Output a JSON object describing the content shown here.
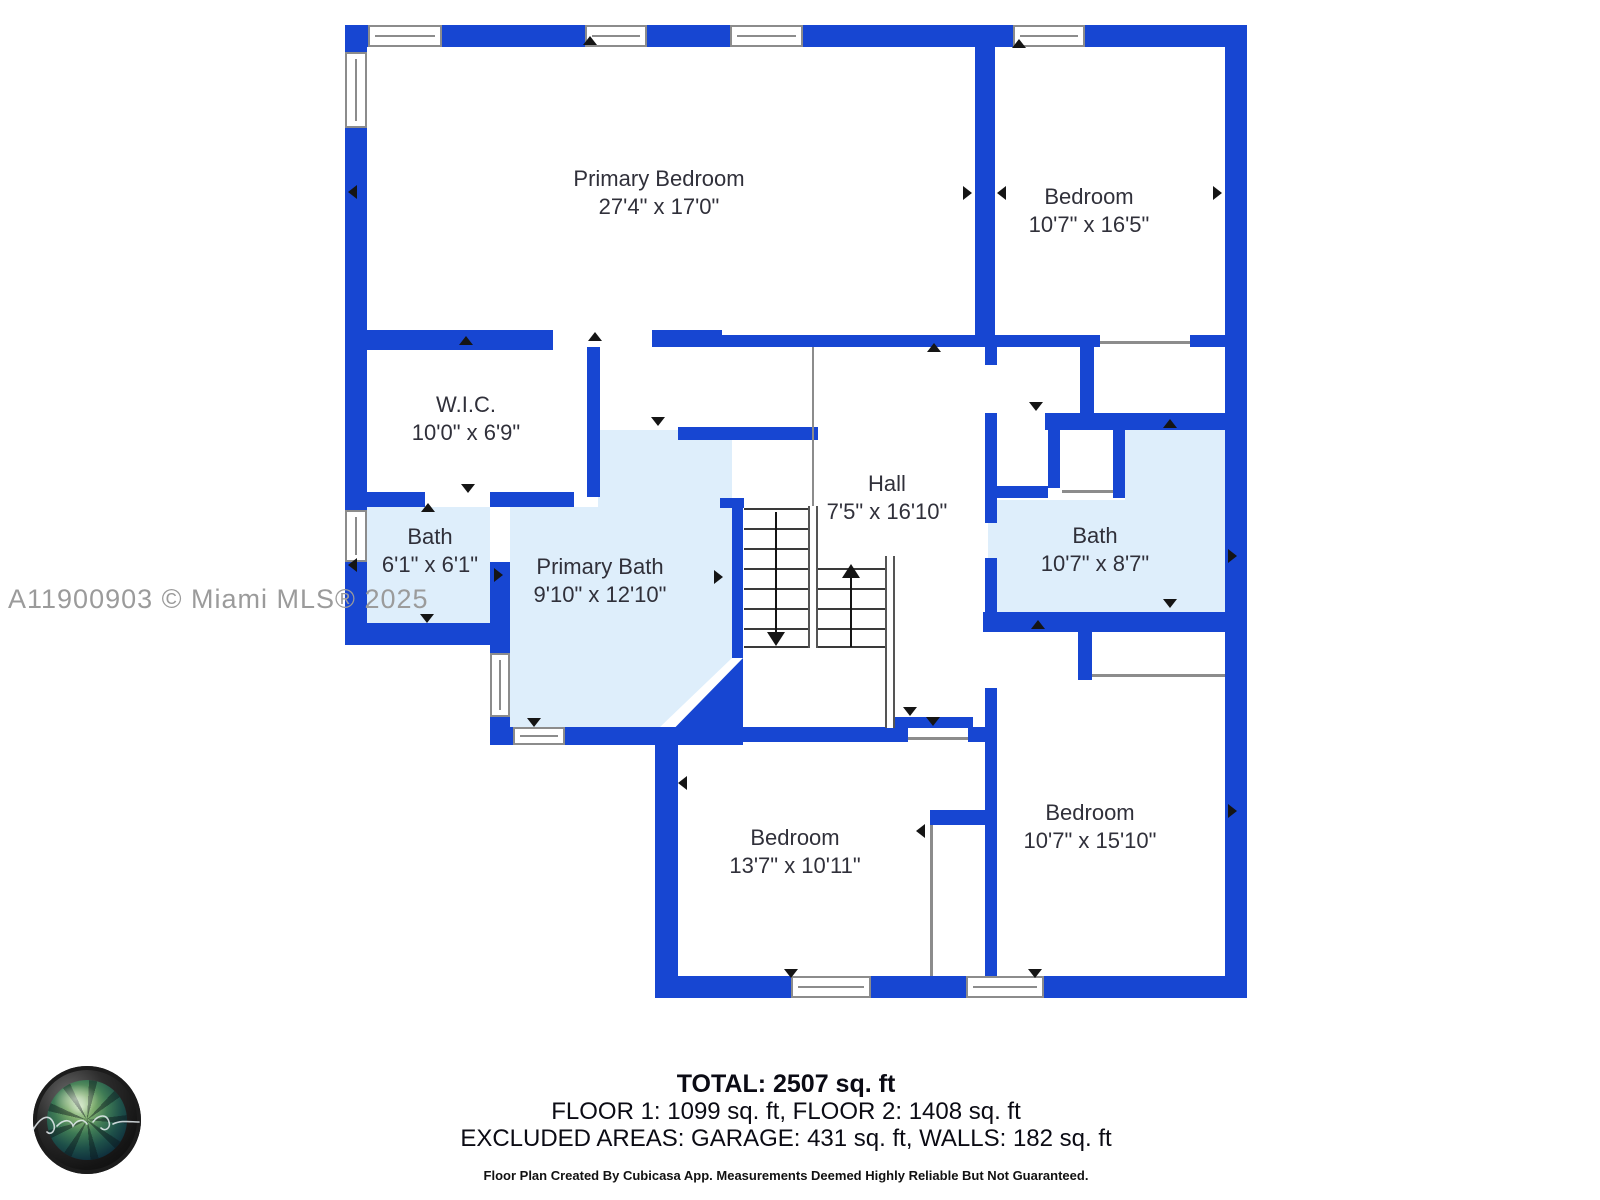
{
  "watermark": "A11900903 © Miami MLS® 2025",
  "colors": {
    "wall": "#1746D2",
    "bath_floor": "#DEEEFB",
    "marker": "#151515",
    "text": "#30303A",
    "watermark": "#9B9B9B"
  },
  "rooms": [
    {
      "name": "Primary Bedroom",
      "dims": "27'4\" x 17'0\""
    },
    {
      "name": "Bedroom",
      "dims": "10'7\" x 16'5\""
    },
    {
      "name": "W.I.C.",
      "dims": "10'0\" x 6'9\""
    },
    {
      "name": "Hall",
      "dims": "7'5\" x 16'10\""
    },
    {
      "name": "Bath",
      "dims": "6'1\" x 6'1\""
    },
    {
      "name": "Primary Bath",
      "dims": "9'10\" x 12'10\""
    },
    {
      "name": "Bath",
      "dims": "10'7\" x 8'7\""
    },
    {
      "name": "Bedroom",
      "dims": "13'7\" x 10'11\""
    },
    {
      "name": "Bedroom",
      "dims": "10'7\" x 15'10\""
    }
  ],
  "footer": {
    "total": "TOTAL: 2507 sq. ft",
    "floors": "FLOOR 1: 1099 sq. ft, FLOOR 2: 1408 sq. ft",
    "excluded": "EXCLUDED AREAS: GARAGE: 431 sq. ft, WALLS: 182 sq. ft",
    "disclaimer": "Floor Plan Created By Cubicasa App. Measurements Deemed Highly Reliable But Not Guaranteed."
  }
}
